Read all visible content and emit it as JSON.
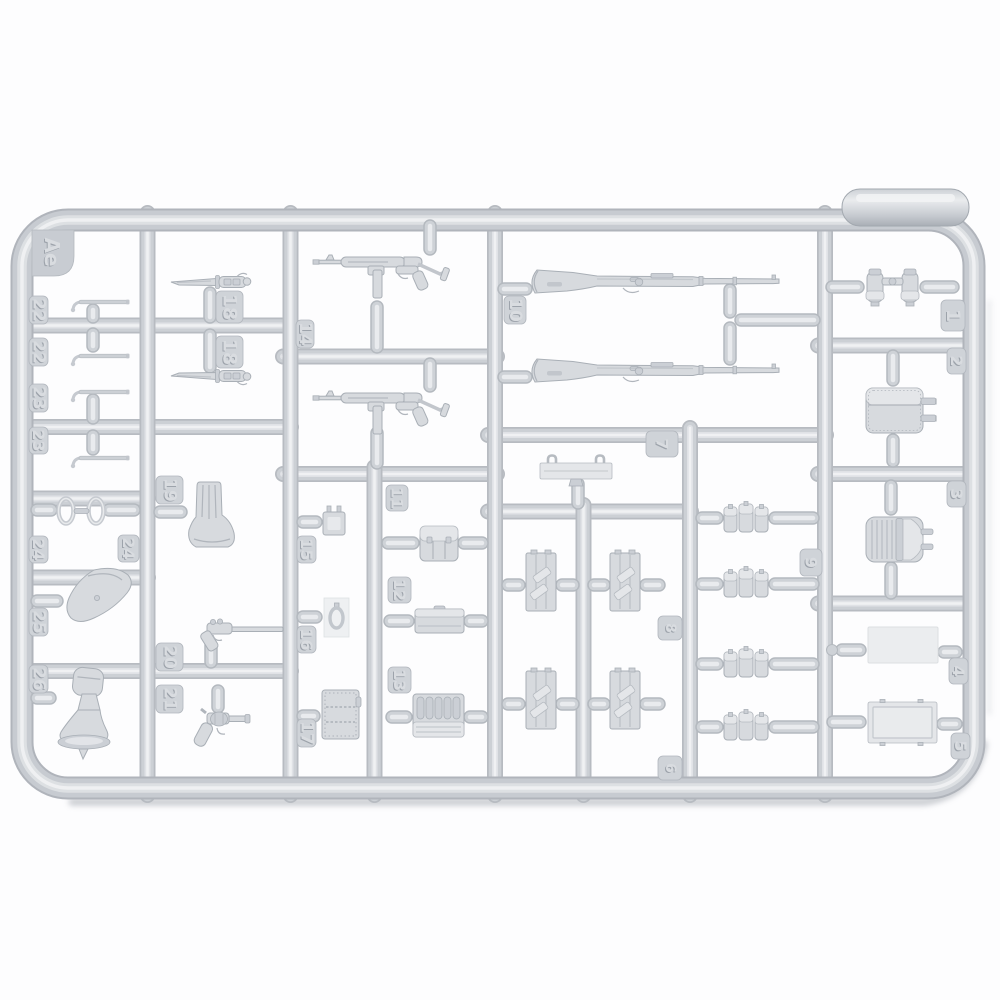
{
  "sprue": {
    "code_label": "Ae",
    "tags": {
      "ae": "Ae",
      "t1": "1",
      "t2": "2",
      "t3": "3",
      "t4": "4",
      "t5": "5",
      "t6": "6",
      "t7": "7",
      "t8": "8",
      "t9": "9",
      "t10": "10",
      "t11": "11",
      "t12": "12",
      "t13": "13",
      "t14": "14",
      "t15": "15",
      "t16": "16",
      "t17": "17",
      "t18a": "18",
      "t18b": "18",
      "t19": "19",
      "t20": "20",
      "t21": "21",
      "t22a": "22",
      "t22b": "22",
      "t23a": "23",
      "t23b": "23",
      "t24a": "24",
      "t24b": "24",
      "t25": "25",
      "t26": "26"
    },
    "parts": {
      "1": "binoculars",
      "2": "canvas-pouch-with-straps",
      "3": "tool-pouch",
      "4": "flat-plate",
      "5": "framed-plate",
      "6": "strapped-panel-pair",
      "7": "hook-bracket",
      "8": "strapped-panel-pair",
      "9": "triple-magazine-pouch",
      "10": "kar98k-rifle",
      "11": "ammo-pouch",
      "12": "flat-box-lid",
      "13": "ribbed-ammo-box",
      "14": "mp40-submachine-gun",
      "15": "buckle-bracket",
      "16": "oval-buckle-on-film",
      "17": "stitched-ammo-box",
      "18": "bayonet-with-scabbard",
      "19": "large-holster",
      "20": "luger-pistol",
      "21": "revolver-flare-pistol",
      "22": "cleaning-rod",
      "23": "cleaning-rod",
      "24": "oval-ring",
      "25": "pistol-holster",
      "26": "holster-with-bell"
    },
    "colors": {
      "background": "#ffffff",
      "plastic_edge": "#b0b4bb",
      "plastic_base": "#c7cbd1",
      "plastic_mid": "#dcdfe2",
      "plastic_highlight": "#eff0f2",
      "part_fill": "#d7dade",
      "tag_fill": "#cfd3d8",
      "shadow": "#9da3ab"
    }
  }
}
